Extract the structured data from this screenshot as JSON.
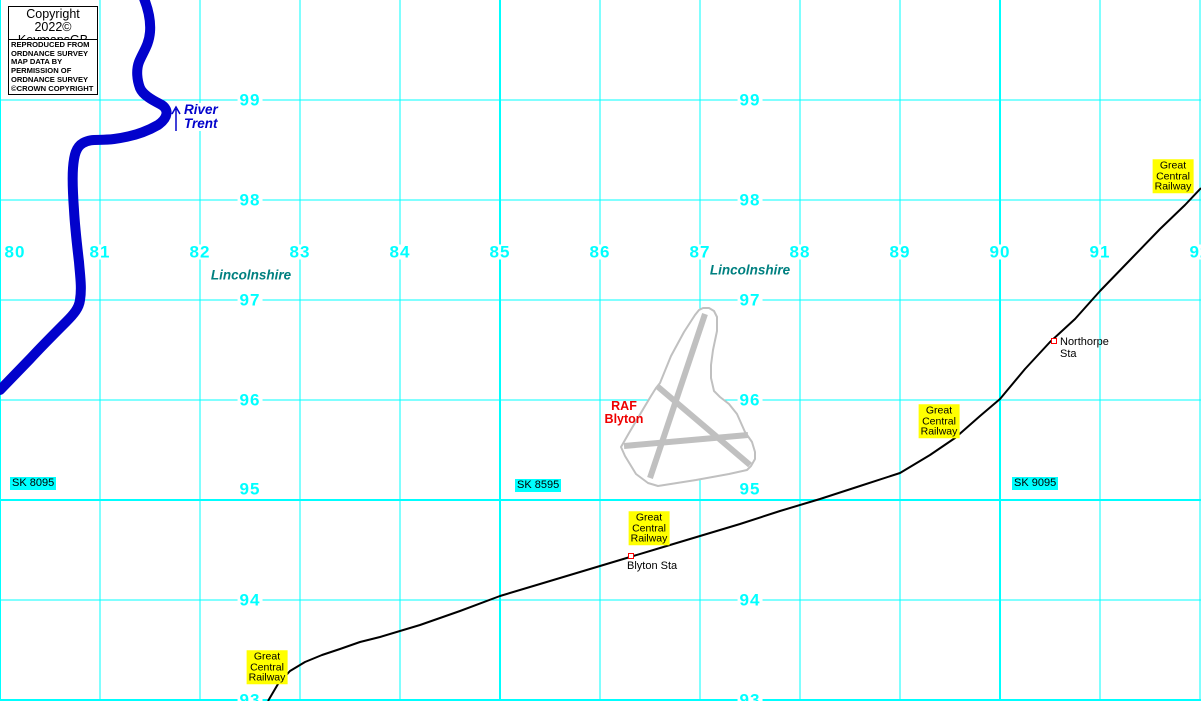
{
  "title": "KeymapsGB map extract - RAF Blyton / Lincolnshire",
  "colors": {
    "grid": "#00ffff",
    "grid_label": "#00ffff",
    "river": "#0202cc",
    "river_label": "#0202cc",
    "railway": "#000000",
    "airfield": "#c0c0c0",
    "county": "#008080",
    "raf": "#ee0000",
    "station_marker": "#ff0000",
    "sign_bg": "#ffff00",
    "sk_bg": "#00ffff",
    "text": "#000000"
  },
  "attribution": {
    "copyright": {
      "line1": "Copyright 2022©",
      "line2": "KeymapsGB"
    },
    "os_notice": {
      "lines": [
        "REPRODUCED FROM",
        "ORDNANCE SURVEY",
        "MAP DATA BY",
        "PERMISSION OF",
        "ORDNANCE SURVEY",
        "©CROWN COPYRIGHT"
      ]
    }
  },
  "grid": {
    "easting_label_cy": 252,
    "eastings": [
      {
        "label": "80",
        "x": 0,
        "label_cx": 15,
        "thick": true
      },
      {
        "label": "81",
        "x": 100
      },
      {
        "label": "82",
        "x": 200
      },
      {
        "label": "83",
        "x": 300
      },
      {
        "label": "84",
        "x": 400
      },
      {
        "label": "85",
        "x": 500,
        "thick": true
      },
      {
        "label": "86",
        "x": 600
      },
      {
        "label": "87",
        "x": 700
      },
      {
        "label": "88",
        "x": 800
      },
      {
        "label": "89",
        "x": 900
      },
      {
        "label": "90",
        "x": 1000,
        "thick": true
      },
      {
        "label": "91",
        "x": 1100
      },
      {
        "label": "92",
        "x": 1200
      }
    ],
    "northing_label_cols": [
      250,
      750
    ],
    "northings": [
      {
        "label": "99",
        "y": 100
      },
      {
        "label": "98",
        "y": 200
      },
      {
        "label": "97",
        "y": 300
      },
      {
        "label": "96",
        "y": 400
      },
      {
        "label": "95",
        "y": 500,
        "thick": true,
        "label_dy": -11
      },
      {
        "label": "94",
        "y": 600
      },
      {
        "label": "93",
        "y": 700,
        "thick": true
      }
    ],
    "sk_labels": [
      {
        "text": "SK 8095",
        "x": 10,
        "y": 477
      },
      {
        "text": "SK 8595",
        "x": 515,
        "y": 479
      },
      {
        "text": "SK 9095",
        "x": 1012,
        "y": 477
      }
    ]
  },
  "features": {
    "river_label": {
      "line1": "River",
      "line2": "Trent"
    },
    "counties": [
      {
        "name": "Lincolnshire",
        "cx": 251,
        "cy": 275
      },
      {
        "name": "Lincolnshire",
        "cx": 750,
        "cy": 270
      }
    ],
    "airfield_label": {
      "line1": "RAF",
      "line2": "Blyton"
    },
    "stations": {
      "northorpe": {
        "line1": "Northorpe",
        "line2": "Sta"
      },
      "blyton": {
        "line1": "Blyton Sta"
      }
    },
    "railway_signs": {
      "lines": [
        "Great",
        "Central",
        "Railway"
      ],
      "positions": [
        {
          "cx": 1173,
          "cy": 176
        },
        {
          "cx": 939,
          "cy": 421
        },
        {
          "cx": 649,
          "cy": 528
        },
        {
          "cx": 267,
          "cy": 667
        }
      ]
    }
  }
}
